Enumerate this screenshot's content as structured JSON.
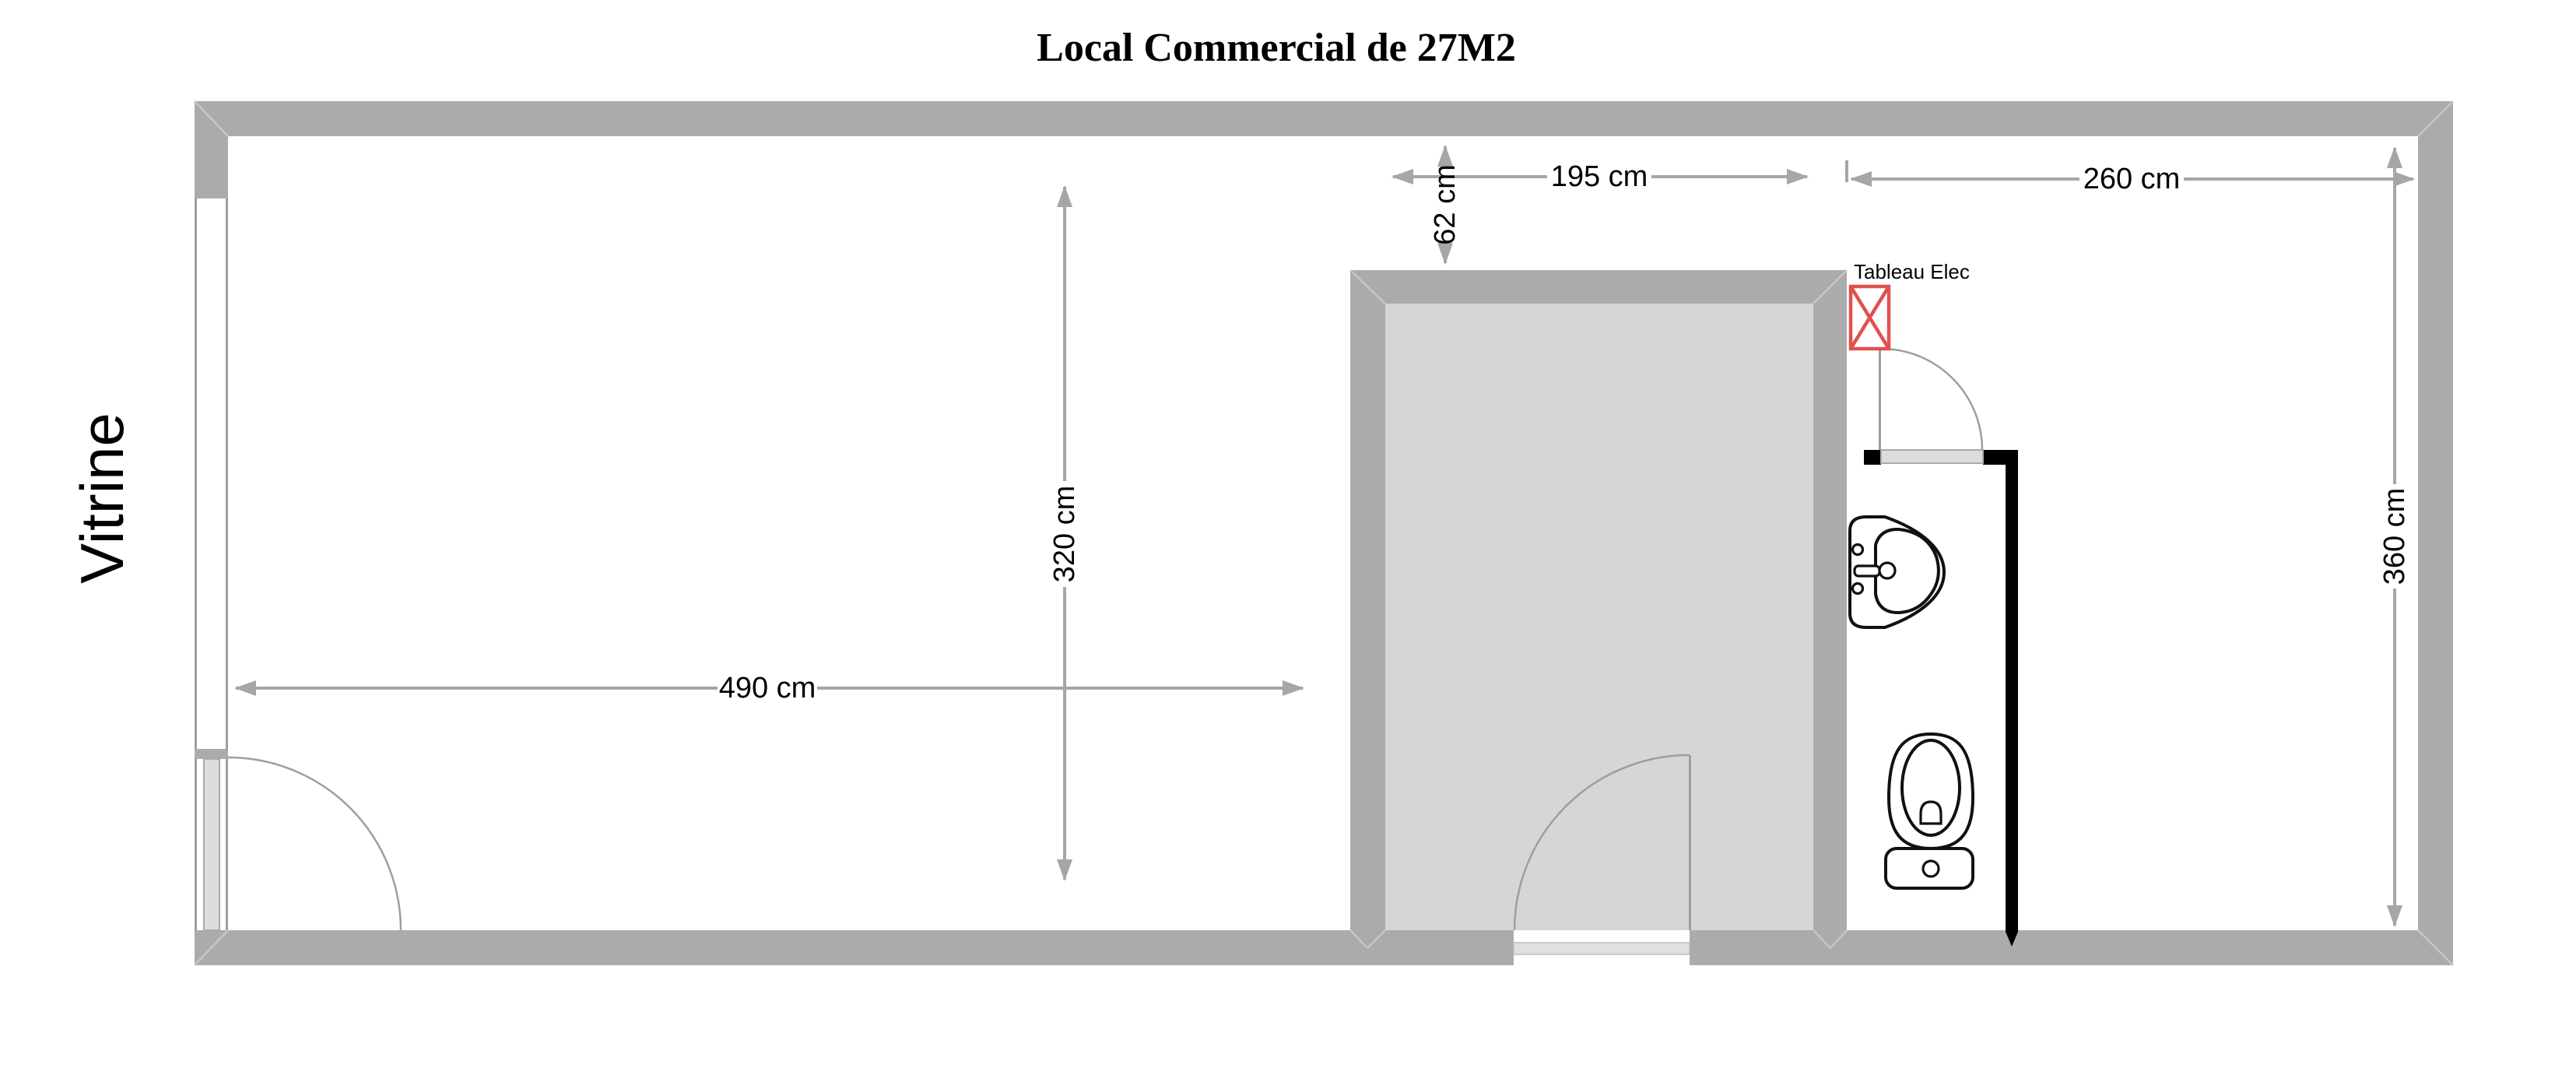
{
  "title": "Local Commercial de 27M2",
  "labels": {
    "vitrine": "Vitrine",
    "tableau_elec": "Tableau Elec"
  },
  "dimensions": {
    "main_width": "490 cm",
    "main_depth": "320 cm",
    "storage_width": "195 cm",
    "storage_gap": "62 cm",
    "wc_width": "260 cm",
    "right_depth": "360 cm"
  },
  "colors": {
    "wall_gray": "#ababab",
    "storage_interior_gray": "#d6d6d6",
    "dimension_gray": "#a6a6a6",
    "door_leaf_gray": "#dcdcdc",
    "partition_black": "#000000",
    "tableau_elec_red": "#e0504e",
    "fixture_outline": "#111111",
    "background": "#ffffff"
  }
}
